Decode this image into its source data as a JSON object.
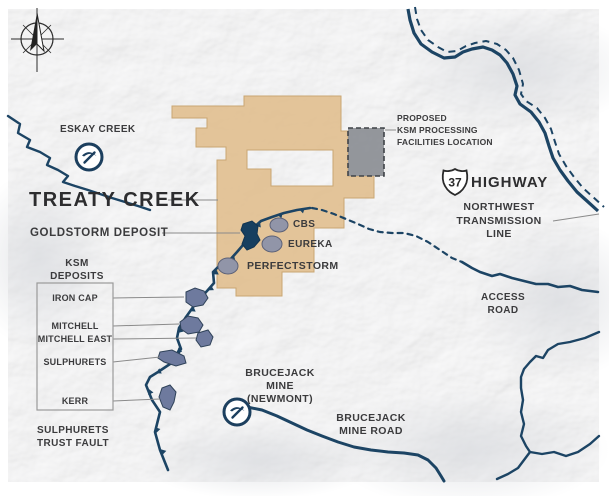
{
  "labels": {
    "eskay_creek": "ESKAY CREEK",
    "treaty_creek": "TREATY CREEK",
    "goldstorm": "GOLDSTORM DEPOSIT",
    "cbs": "CBS",
    "eureka": "EUREKA",
    "perfectstorm": "PERFECTSTORM",
    "facility": [
      "PROPOSED",
      "KSM PROCESSING",
      "FACILITIES LOCATION"
    ],
    "highway_number": "37",
    "highway": "HIGHWAY",
    "transmission": [
      "NORTHWEST",
      "TRANSMISSION",
      "LINE"
    ],
    "access_road": [
      "ACCESS",
      "ROAD"
    ],
    "ksm_title": [
      "KSM",
      "DEPOSITS"
    ],
    "ksm_items": [
      "IRON CAP",
      "MITCHELL",
      "MITCHELL EAST",
      "SULPHURETS",
      "KERR"
    ],
    "fault": [
      "SULPHURETS",
      "TRUST FAULT"
    ],
    "brucejack_mine": [
      "BRUCEJACK MINE",
      "(NEWMONT)"
    ],
    "brucejack_road": [
      "BRUCEJACK",
      "MINE ROAD"
    ]
  },
  "legend_semantics": {
    "claim_area": "Treaty Creek claim boundary (tan polygon)",
    "facility_square": "Proposed KSM processing facilities location (gray dashed square)",
    "fault_line": "Sulphurets trust fault with thrust teeth",
    "mine_icon": "pickaxe mine symbol"
  },
  "colors": {
    "navy_line": "#1c4464",
    "claim_fill": "#e0bd8c",
    "claim_stroke": "#c9a672",
    "facility_fill": "#8b8e94",
    "facility_border": "#3f4348",
    "deposit_fill": "#6e7a9e",
    "satellite_deposit_fill": "#9195a8",
    "goldstorm_fill": "#173f5f",
    "label_text": "#3b3b3d",
    "map_base": "#f2f2f3",
    "leader_line": "#8a8a8a"
  }
}
